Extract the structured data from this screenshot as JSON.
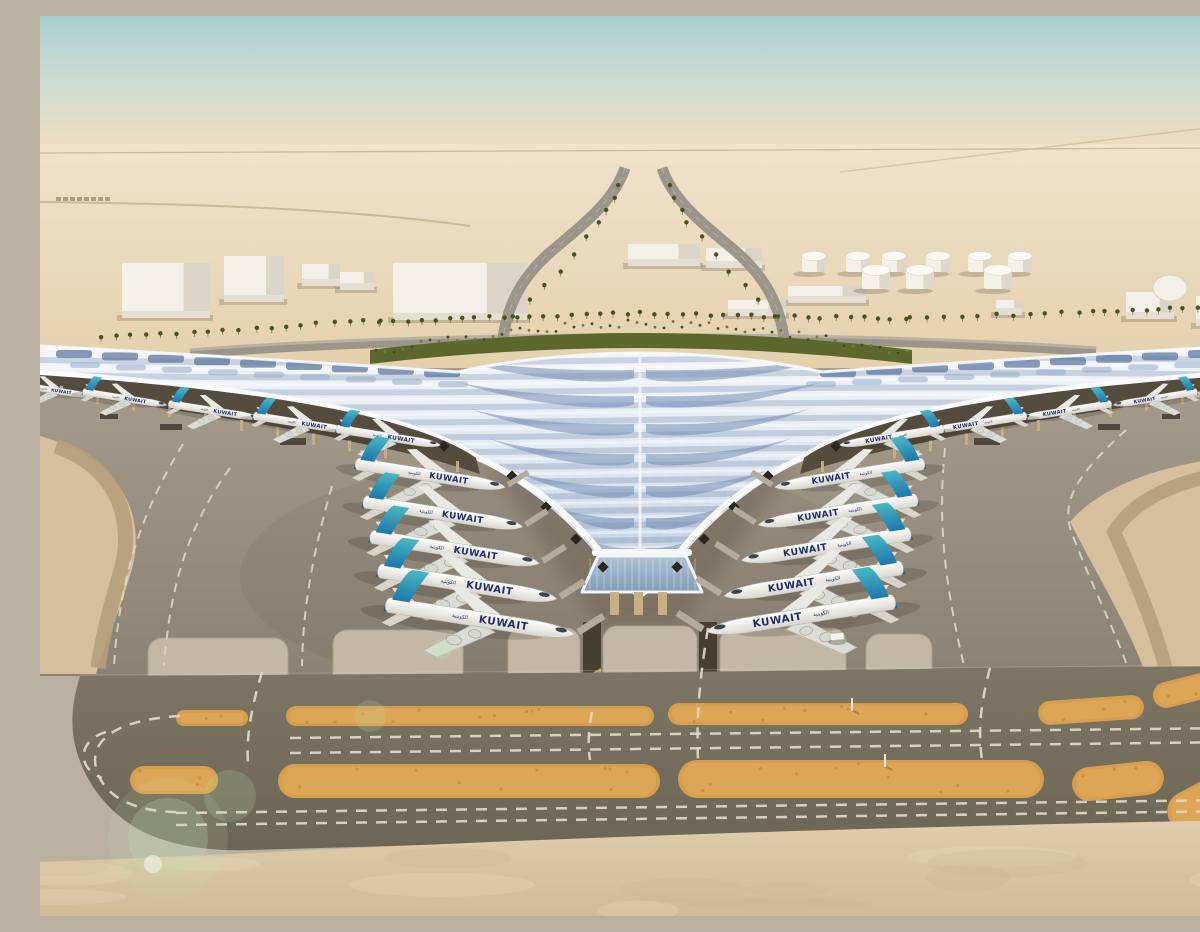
{
  "caption": "Aerial architectural rendering of a desert airport: a vast rippled silver-blue canopy roof sweeps down to a central V point between two long gate wings, with Kuwait Airways jets parked nose-in on both sides, gray aprons with dashed taxi guidance lines, dark taxiway bands with unpaved orange strips, palm-lined approach roads, white warehouses and fuel tanks under a hazy teal desert sky.",
  "aircraft": {
    "titles_latin": "KUWAIT",
    "titles_arabic": "الكويتية",
    "main_gate_jets_left": 5,
    "main_gate_jets_right": 5,
    "pier_jets_left": 5,
    "pier_jets_right": 5,
    "fuselage_color": "#ffffff",
    "tail_color": "#35a9bb",
    "tail_accent_color": "#1b5fa8",
    "titles_color": "#1d2f6e"
  },
  "palette": {
    "sky_top": "#a9cfd0",
    "sky_mid": "#cfdcd2",
    "horizon_haze": "#e8dcc3",
    "desert_far": "#efe3cb",
    "desert_near": "#e2cda8",
    "sand_wedge": "#d5bf9d",
    "sand_stripe": "#b69e7b",
    "foreground_sand_top": "#dfcdab",
    "foreground_sand_bottom": "#d0bb97",
    "apron_top": "#a59c8c",
    "apron_bottom": "#8a8272",
    "stand_panel": "#c3b8a5",
    "taxiway_top": "#7d7664",
    "taxiway_bottom": "#6c6654",
    "unpaved_orange": "#d89e4f",
    "unpaved_orange_light": "#e2ab5c",
    "marking_dash": "#ddd6c4",
    "roof_white": "#f4f6f9",
    "roof_silver": "#dde6ef",
    "roof_blue": "#b9c9dd",
    "roof_panel_blue": "#607aa0",
    "fascia_white": "#f9fafb",
    "underroof_dark": "#544c3d",
    "column_tan": "#c9ae80",
    "glass_blue": "#aec2d6",
    "hedge_green": "#5c672c",
    "palm_green": "#47531f",
    "building_white": "#f3f0e9",
    "road_gray": "#9c9589"
  },
  "scene": {
    "time": "day, hazy desert light",
    "view": "elevated aerial, landside behind terminal at top, airside apron and taxiways in foreground",
    "features": [
      "trefoil canopy roof with wave/chevron skylight pattern",
      "central glazed entrance at the V point with tan columns",
      "two mirrored fans of five widebody jets at the central canopy",
      "smaller jets along the left and right gate piers",
      "white dashed taxi guidance arcs on the apron",
      "rounded light concrete stand panels with service trenches",
      "dark taxiway band with two long orange unpaved strips and dashed centerlines",
      "forked palm-lined approach road and crescent boulevard",
      "white warehouses, sheds and a fuel-tank farm on the horizon",
      "green lens-flare spots over the lower-left foreground"
    ]
  }
}
